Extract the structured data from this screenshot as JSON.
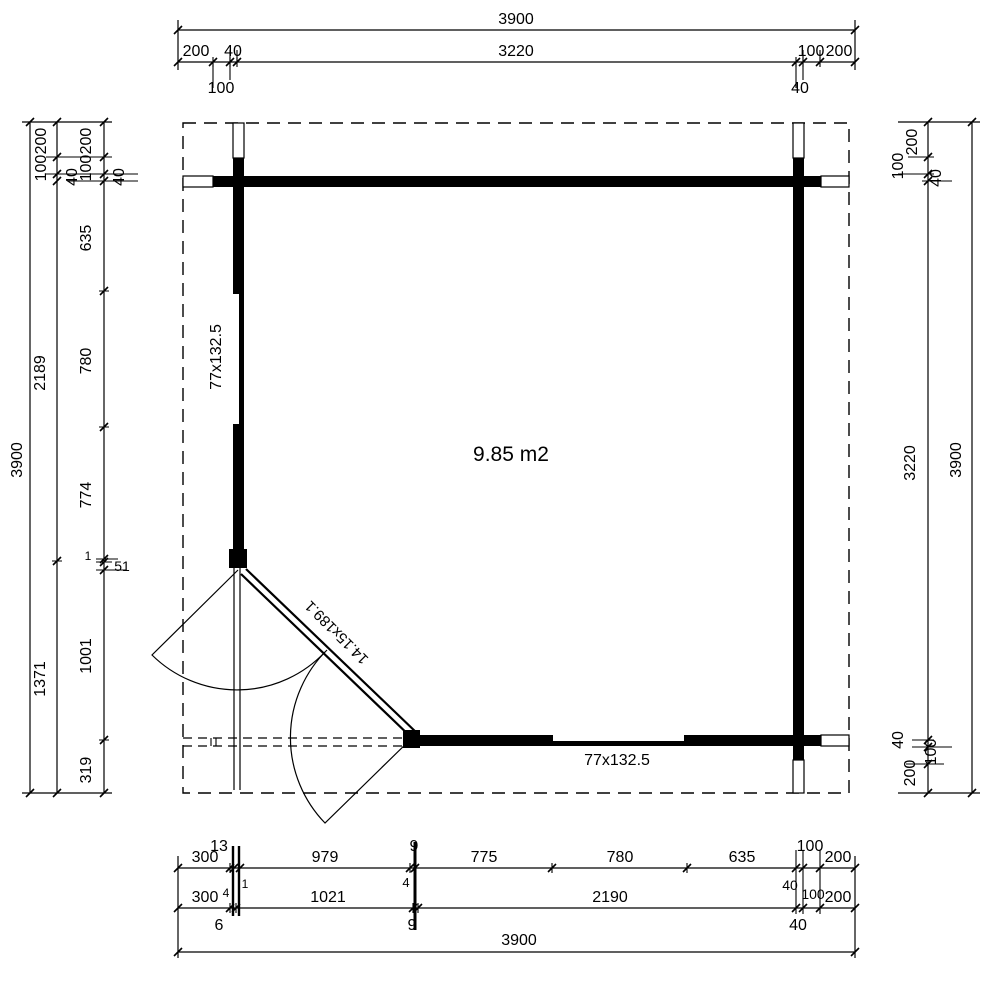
{
  "drawing": {
    "area_label": "9.85 m2",
    "window_left_label": "77x132.5",
    "window_bottom_label": "77x132.5",
    "door_label": "14.15x189.1"
  },
  "dims_top": {
    "total": "3900",
    "seg_200_left": "200",
    "seg_40_left": "40",
    "seg_3220": "3220",
    "seg_100_right": "100",
    "seg_200_right": "200",
    "below_100_left": "100",
    "below_40_right": "40"
  },
  "dims_left": {
    "total": "3900",
    "mid_200": "200",
    "mid_100": "100",
    "mid_40": "40",
    "mid_2189": "2189",
    "mid_1371": "1371",
    "in_200": "200",
    "in_100": "100",
    "in_40": "40",
    "in_635": "635",
    "in_780": "780",
    "in_774": "774",
    "in_1": "1",
    "in_51": "51",
    "in_1001": "1001",
    "in_319": "319"
  },
  "dims_right": {
    "total": "3900",
    "in_200_top": "200",
    "in_100_top": "100",
    "in_40_top": "40",
    "in_3220": "3220",
    "in_40_bottom": "40",
    "in_100_bottom": "100",
    "in_200_bottom": "200"
  },
  "dims_bottom": {
    "total": "3900",
    "r1_300": "300",
    "r1_13": "13",
    "r1_979": "979",
    "r1_9": "9",
    "r1_775": "775",
    "r1_780": "780",
    "r1_635": "635",
    "r1_100": "100",
    "r1_200": "200",
    "m_1": "1",
    "m_4_left": "4",
    "m_4_mid": "4",
    "m_40": "40",
    "m_100": "100",
    "r2_300": "300",
    "r2_1021": "1021",
    "r2_2190": "2190",
    "r2_200": "200",
    "b_6": "6",
    "b_9": "9",
    "b_40": "40"
  },
  "colors": {
    "ink": "#000000",
    "paper": "#ffffff"
  }
}
